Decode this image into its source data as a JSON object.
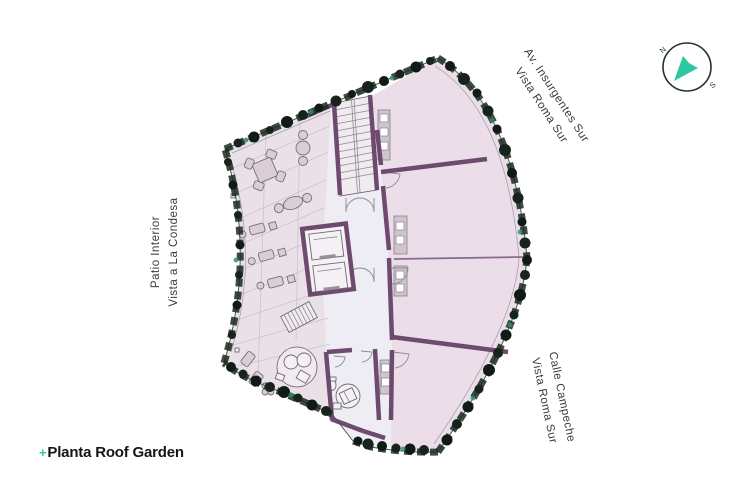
{
  "title": {
    "marker": "+",
    "text": "Planta Roof Garden"
  },
  "street_labels": {
    "insurgentes": {
      "line1": "Av. Insurgentes Sur",
      "line2": "Vista Roma Sur"
    },
    "patio_interior": {
      "line1": "Patio Interior",
      "line2": "Vista a La Condesa"
    },
    "campeche": {
      "line1": "Calle Campeche",
      "line2": "Vista Roma Sur"
    }
  },
  "compass": {
    "north": "N",
    "south": "S"
  },
  "colors": {
    "accent_teal": "#2ec7a0",
    "wall_purple": "#6d4a6e",
    "wall_purple_light": "#8a6a8c",
    "unit_fill": "#ecdee8",
    "terrace_fill": "#e9e1e7",
    "corridor_fill": "#eeedf4",
    "plant_dark": "#1a2a20",
    "outline": "#55505a",
    "label_text": "#3a3a3a",
    "title_text": "#151515",
    "compass_ink": "#223038"
  }
}
